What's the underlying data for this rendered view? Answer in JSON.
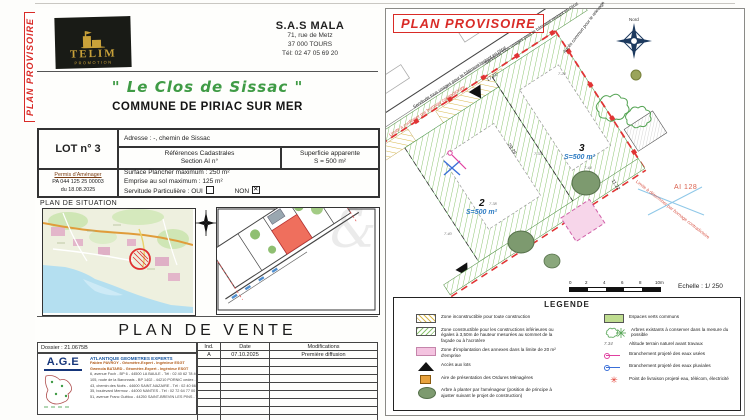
{
  "colors": {
    "stamp_red": "#d92b27",
    "title_green": "#3f9b45",
    "lot_blue": "#2e7cc3",
    "logo_gold": "#c9a23a",
    "legend_green": "#bfdd90"
  },
  "side_stamp": "PLAN PROVISOIRE",
  "left_page": {
    "logo": {
      "name": "TELIM",
      "sub": "PROMOTION"
    },
    "company": {
      "name": "S.A.S MALA",
      "addr1": "71, rue de Metz",
      "addr2": "37 000 TOURS",
      "phone": "Tél: 02 47 05 69 20"
    },
    "title": "\" Le Clos de Sissac \"",
    "subtitle": "COMMUNE DE PIRIAC SUR MER",
    "lot": {
      "number": "LOT n° 3",
      "adresse": "Adresse : -, chemin de Sissac",
      "cadastre1": "Références Cadastrales",
      "cadastre2": "Section AI n°",
      "superficie1": "Superficie apparente",
      "superficie2": "S = 500 m²",
      "permis_title": "Permis d'Aménager",
      "permis1": "PA 044 125 25 00003",
      "permis2": "du 18.08.2025",
      "surface": "Surface Plancher maximum : 250 m²",
      "emprise": "Emprise au sol maximum : 125 m²",
      "servitude_label": "Servitude Particulière :",
      "oui_label": "OUI",
      "non_label": "NON"
    },
    "situation_label": "PLAN DE SITUATION",
    "vente_title": "PLAN DE VENTE",
    "dossier": "Dossier : 21.0675B",
    "surveyor": {
      "acronym": "A.G.E",
      "name": "ATLANTIQUE GEOMETRES EXPERTS",
      "lines": [
        "Fabien PAVROY - Géomètre-Expert - Ingénieur ESGT",
        "Gwenola BATARD - Géomètre-Expert - Ingénieur ESGT",
        "6, avenue Foch - BP 6 - 44500 LA BAULE - Tél : 02 40 62 78 46",
        "105, route de la Baronnais - BP 1402 - 44210 PORNIC cedex - Tél : 02 40 82 01 44",
        "43, chemin des Noës - 44600 SAINT-NAZAIRE - Tél : 02 40 66 22 04",
        "35, boulevard Mermoz - 44000 NANTES - Tél : 02 72 64 77 00",
        "51, avenue Franc Guittou - 44250 SAINT-BREVIN LES PINS - Tél : 02 51 74 64 10"
      ]
    },
    "revisions": {
      "col_ind": "Ind.",
      "col_date": "Date",
      "col_mod": "Modifications",
      "row_ind": "A",
      "row_date": "07.10.2025",
      "row_mod": "Première diffusion"
    }
  },
  "right_page": {
    "stamp": "PLAN PROVISOIRE",
    "north": "Nord",
    "parcel_ref": "AI 128",
    "lot2": {
      "num": "2",
      "area": "S=500 m²"
    },
    "lot3": {
      "num": "3",
      "area": "S=500 m²"
    },
    "notes": {
      "limite_road": "Limite à confirmer par bornage contradictoire",
      "limite_right": "Limite à déterminer par bornage contradictoire",
      "servitude": "Servitude tous usages pour le bâtiment restant en l'état",
      "acces": "Accès commun pour le relevage"
    },
    "dims": {
      "d1": "17.22",
      "d2": "29.26",
      "d3": "11.22"
    },
    "spots": [
      "7.23",
      "7.24",
      "7.33",
      "7.38",
      "7.40",
      "7.44"
    ],
    "scale": {
      "t0": "0",
      "t2": "2",
      "t4": "4",
      "t6": "6",
      "t8": "8",
      "t10": "10m",
      "echelle": "Echelle : 1/ 250"
    },
    "legend": {
      "title": "LEGENDE",
      "left": [
        {
          "label": "Zone inconstructible pour toute construction"
        },
        {
          "label": "Zone constructible pour les constructions inférieures ou égales à 3,50m de hauteur mesurées au sommet de la façade ou à l'acrotère"
        },
        {
          "label": "Zone d'implantation des annexes dans la limite de 20 m² d'emprise"
        },
        {
          "label": "Accès aux lots"
        },
        {
          "label": "Aire de présentation des Ordures Ménagères"
        },
        {
          "label": "Arbre à planter par l'aménageur (position de principe à ajuster suivant le projet de construction)"
        }
      ],
      "right": [
        {
          "label": "Espaces verts communs"
        },
        {
          "label": "Arbres existants à conserver dans la mesure du possible"
        },
        {
          "symbol": "7.34",
          "label": "Altitude terrain naturel avant travaux"
        },
        {
          "label": "Branchement projeté des eaux usées"
        },
        {
          "label": "Branchement projeté des eaux pluviales"
        },
        {
          "label": "Point de livraison projeté eau, télécom, électricité"
        }
      ]
    }
  }
}
